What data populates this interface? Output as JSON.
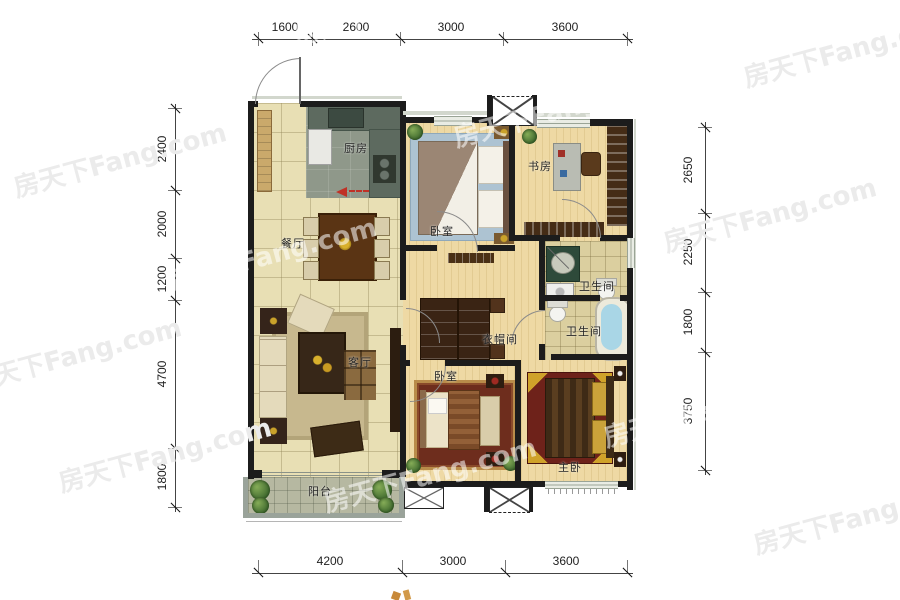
{
  "watermark": "房天下Fang.com",
  "dimensions": {
    "top": [
      "1600",
      "2600",
      "3000",
      "3600"
    ],
    "bottom": [
      "4200",
      "3000",
      "3600"
    ],
    "left": [
      "2400",
      "2000",
      "1200",
      "4700",
      "1800"
    ],
    "right": [
      "2650",
      "2250",
      "1800",
      "3750"
    ]
  },
  "rooms": {
    "kitchen": "厨房",
    "dining": "餐厅",
    "living": "客厅",
    "bedroom_top": "卧室",
    "study": "书房",
    "bathroom_upper": "卫生间",
    "bathroom_lower": "卫生间",
    "cloakroom": "衣帽间",
    "bedroom_mid": "卧室",
    "master_bedroom": "主卧",
    "balcony": "阳台"
  },
  "colors": {
    "wall": "#1c1c1c",
    "tile_floor": "#e8dfb4",
    "wood_floor": "#eed9a4",
    "kitchen_floor": "#8f988a",
    "balcony_floor": "#b6b8a1",
    "entry_arrow": "#c03126",
    "bathtub": "#a9d6e6"
  }
}
